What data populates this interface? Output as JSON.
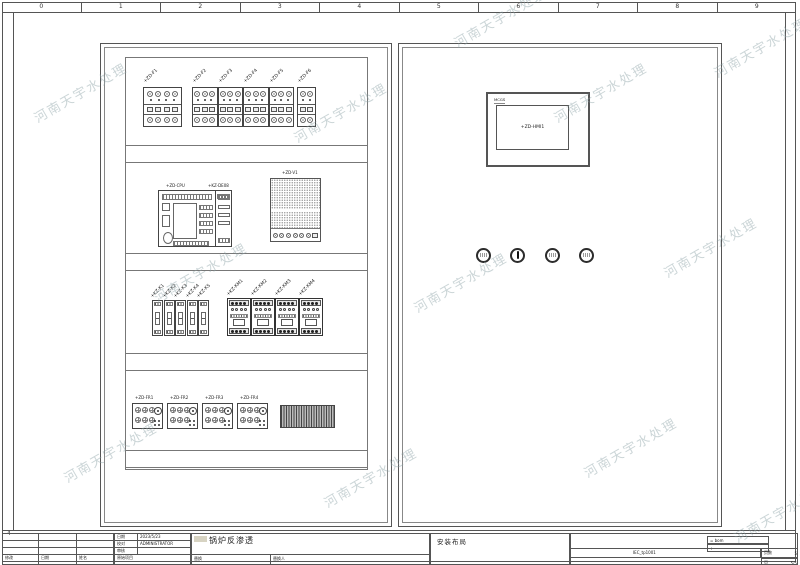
{
  "sheet": {
    "ruler_numbers": [
      "0",
      "1",
      "2",
      "3",
      "4",
      "5",
      "6",
      "7",
      "8",
      "9"
    ],
    "row_marker": "4"
  },
  "watermark": {
    "text": "河南天宇水处理"
  },
  "left_cabinet": {
    "breakers": [
      {
        "label": "+ZD-F1",
        "poles": 4
      },
      {
        "label": "+ZD-F2",
        "poles": 3
      },
      {
        "label": "+ZD-F3",
        "poles": 3
      },
      {
        "label": "+ZD-F4",
        "poles": 3
      },
      {
        "label": "+ZD-F5",
        "poles": 3
      },
      {
        "label": "+ZD-F6",
        "poles": 2
      }
    ],
    "plc": {
      "cpu_label": "+ZD-CPU",
      "ext_label": "+KZ-DE08"
    },
    "vfd": {
      "label": "+ZD-V1"
    },
    "relays": [
      {
        "label": "+KZ-K1"
      },
      {
        "label": "+KZ-K2"
      },
      {
        "label": "+KZ-K3"
      },
      {
        "label": "+KZ-K4"
      },
      {
        "label": "+KZ-K5"
      }
    ],
    "contactors": [
      {
        "label": "+KZ-KM1"
      },
      {
        "label": "+KZ-KM2"
      },
      {
        "label": "+KZ-KM3"
      },
      {
        "label": "+KZ-KM4"
      }
    ],
    "thermal_relays": [
      {
        "label": "+ZD-FR1"
      },
      {
        "label": "+ZD-FR2"
      },
      {
        "label": "+ZD-FR3"
      },
      {
        "label": "+ZD-FR4"
      }
    ]
  },
  "right_cabinet": {
    "hmi": {
      "brand": "MCGS",
      "label": "+ZD-HMI1"
    },
    "buttons": [
      {
        "type": "pushbutton"
      },
      {
        "type": "selector"
      },
      {
        "type": "pushbutton"
      },
      {
        "type": "pushbutton"
      }
    ]
  },
  "title_block": {
    "title": "锅炉反渗透",
    "subtitle": "安装布局",
    "labels": {
      "date": "日期",
      "checked": "校对",
      "reviewed": "审核",
      "orig_project": "原始项目",
      "modify": "修改",
      "date2": "日期",
      "name": "姓名",
      "replace": "替换",
      "replace_by": "替换人",
      "pages": "页数",
      "page": "页"
    },
    "values": {
      "date": "2023/5/23",
      "checked": "ADMINISTRATOR",
      "bom": "= bom",
      "plus": "+",
      "drawing_no": "IEC_tp1001",
      "pages": "5",
      "page": "5/5"
    }
  }
}
